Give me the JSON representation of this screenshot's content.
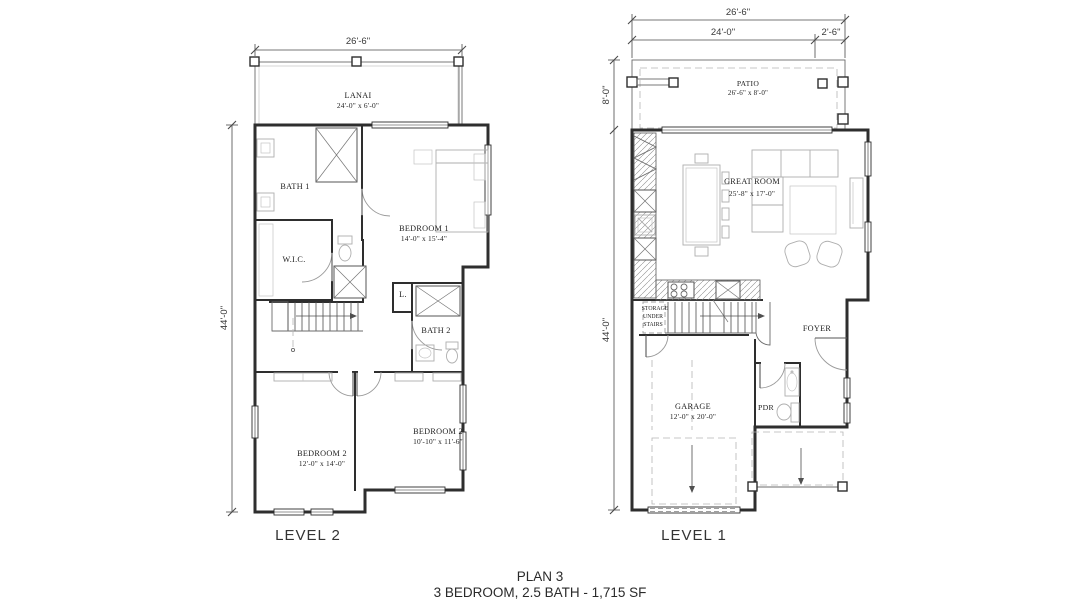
{
  "colors": {
    "ink": "#2e2e2e",
    "furniture": "#aeaeae",
    "background": "#ffffff"
  },
  "plan_title": {
    "line1": "PLAN 3",
    "line2": "3 BEDROOM, 2.5 BATH - 1,715 SF"
  },
  "level2": {
    "name": "LEVEL 2",
    "dims": {
      "width": "26'-6\"",
      "height": "44'-0\""
    },
    "rooms": {
      "lanai": {
        "name": "LANAI",
        "size": "24'-0\" x 6'-0\""
      },
      "bath1": {
        "name": "BATH 1"
      },
      "wic": {
        "name": "W.I.C."
      },
      "bedroom1": {
        "name": "BEDROOM 1",
        "size": "14'-0\" x 15'-4\""
      },
      "linen": {
        "name": "L."
      },
      "bath2": {
        "name": "BATH 2"
      },
      "stair_note": "DN 17R",
      "bedroom2_left": {
        "name": "BEDROOM 2",
        "size": "12'-0\" x 14'-0\""
      },
      "bedroom2_right": {
        "name": "BEDROOM 2",
        "size": "10'-10\" x 11'-6\""
      }
    }
  },
  "level1": {
    "name": "LEVEL 1",
    "dims": {
      "width_total": "26'-6\"",
      "width_main": "24'-0\"",
      "width_side": "2'-6\"",
      "patio_depth": "8'-0\"",
      "height": "44'-0\""
    },
    "rooms": {
      "patio": {
        "name": "PATIO",
        "size": "26'-6\" x 8'-0\""
      },
      "great_room": {
        "name": "GREAT ROOM",
        "size": "25'-8\" x 17'-0\""
      },
      "storage": {
        "line1": "STORAGE",
        "line2": "UNDER",
        "line3": "STAIRS"
      },
      "stair_note": "UP 17R",
      "foyer": {
        "name": "FOYER"
      },
      "garage": {
        "name": "GARAGE",
        "size": "12'-0\" x 20'-0\""
      },
      "pdr": {
        "name": "PDR"
      }
    }
  }
}
